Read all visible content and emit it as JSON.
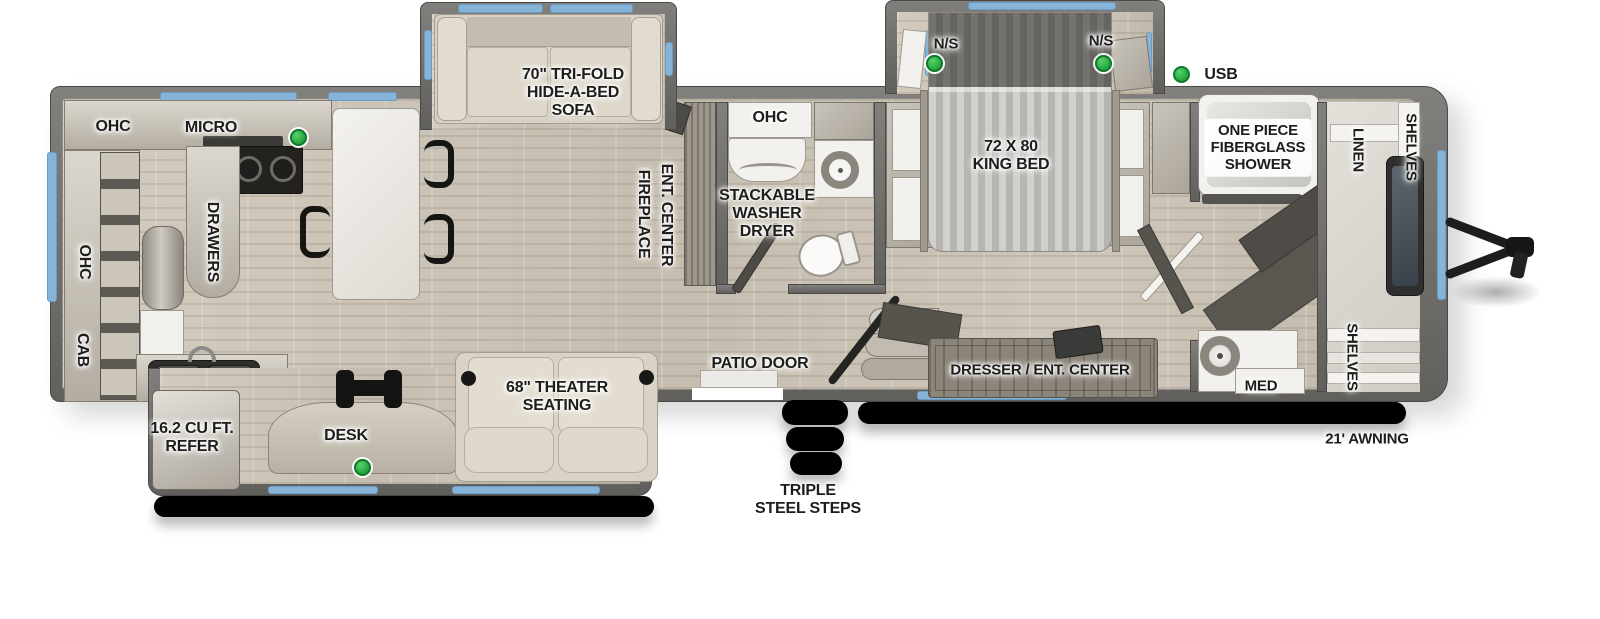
{
  "colors": {
    "wall_gray": "#6f6e6a",
    "floor_wood": "#ccc4b6",
    "window_blue": "#86b3d8",
    "usb_green": "#2fae47",
    "awning_black": "#161615",
    "label_text": "#1d1d1b",
    "furniture_beige": "#d9d2c6"
  },
  "legend": {
    "usb_label": "USB"
  },
  "kitchen": {
    "ohc_top": "OHC",
    "micro": "MICRO",
    "drawers": "DRAWERS",
    "ohc_wall": "OHC",
    "cab": "CAB"
  },
  "rear_slide": {
    "refer_line1": "16.2 CU FT.",
    "refer_line2": "REFER",
    "desk": "DESK",
    "theater_line1": "68\" THEATER",
    "theater_line2": "SEATING"
  },
  "living": {
    "sofa_line1": "70\" TRI-FOLD",
    "sofa_line2": "HIDE-A-BED",
    "sofa_line3": "SOFA",
    "fireplace": "FIREPLACE",
    "ent_center": "ENT. CENTER"
  },
  "mid_bath": {
    "ohc": "OHC",
    "washer_line1": "STACKABLE",
    "washer_line2": "WASHER",
    "washer_line3": "DRYER"
  },
  "entry": {
    "patio_door": "PATIO DOOR",
    "steps_line1": "TRIPLE",
    "steps_line2": "STEEL STEPS"
  },
  "bedroom": {
    "ns_left": "N/S",
    "ns_right": "N/S",
    "bed_line1": "72 X 80",
    "bed_line2": "KING BED",
    "dresser": "DRESSER / ENT. CENTER"
  },
  "front_bath": {
    "shower_line1": "ONE PIECE",
    "shower_line2": "FIBERGLASS",
    "shower_line3": "SHOWER",
    "med": "MED"
  },
  "front_closet": {
    "linen": "LINEN",
    "shelves_top": "SHELVES",
    "shelves_bottom": "SHELVES"
  },
  "exterior": {
    "awning": "21' AWNING"
  }
}
